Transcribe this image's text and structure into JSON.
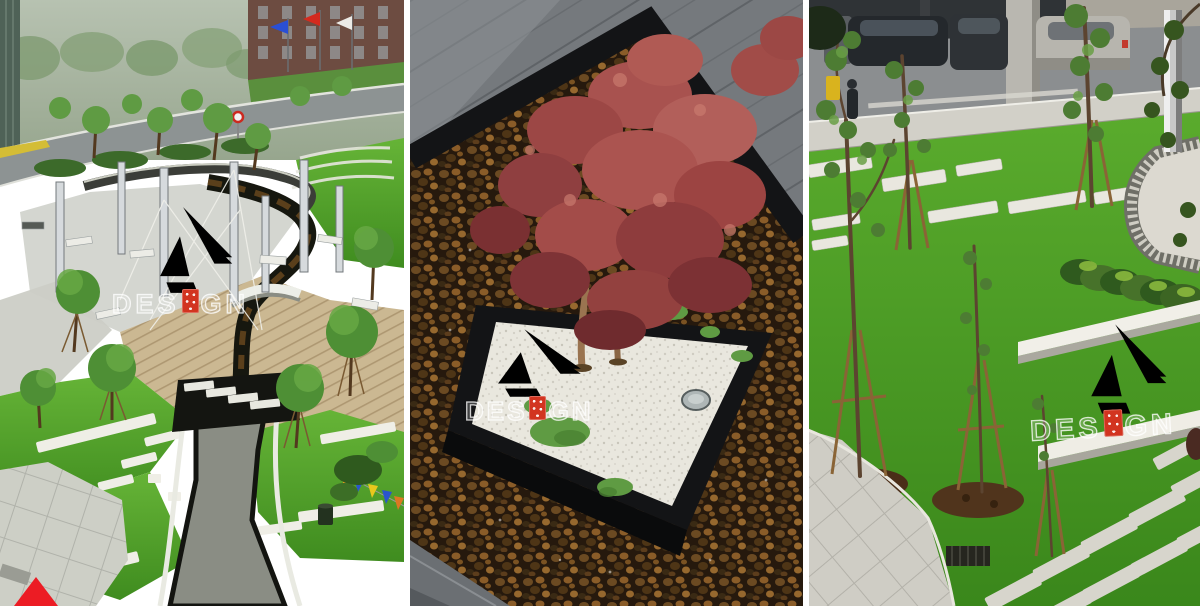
{
  "page": {
    "background": "#ffffff"
  },
  "watermark": {
    "text_before_seal": "DES",
    "text_after_seal": "GN",
    "text_full": "DESIGN",
    "seal_color": "#d23420",
    "letter_style": "white-outline"
  },
  "panels": [
    {
      "name": "aerial-park-plaza",
      "description": "Aerial view of landscaped plaza: curving black-edged stream with arched bridge, timber deck, steel pergola posts, lawns with white stepping-stone strips, perimeter road, brick building with three flags"
    },
    {
      "name": "maple-gravel-planter",
      "description": "Red Japanese maple in a square black-edged planter of white gravel with a round glass uplight, set in brown pebbles beside dark slate paving"
    },
    {
      "name": "lawn-stepping-strips",
      "description": "Young staked trees on bright lawn with white stone strips, clipped hedge, gravel-edged white disc, stainless column, parked cars and paver path with drain grate"
    }
  ],
  "corner_marker": {
    "shape": "red-triangle",
    "color": "#ec1c24"
  }
}
